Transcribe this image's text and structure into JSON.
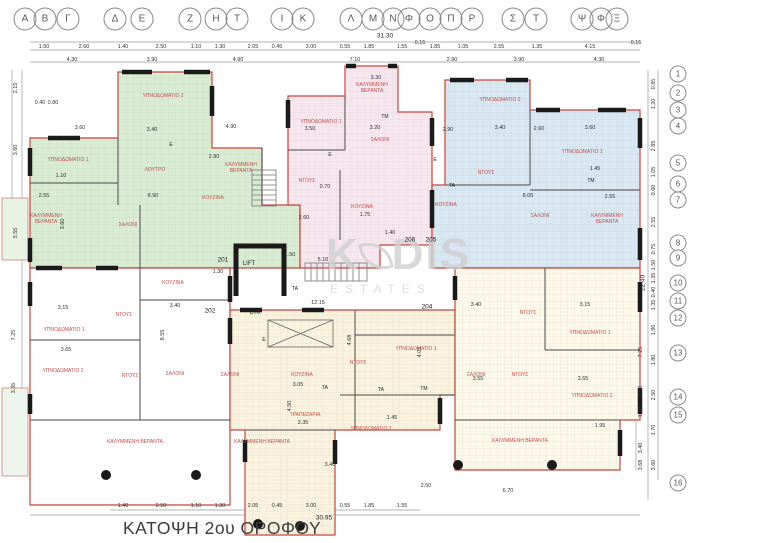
{
  "title": "ΚΑΤΟΨΗ 2ου ΟΡΟΦΟΥ",
  "lift_label": "LIFT",
  "watermark": {
    "part1": "K",
    "part2": "DIS",
    "sub": "ESTATES"
  },
  "colors": {
    "unit_green": "#d9ecd3",
    "unit_pink": "#f6e7ef",
    "unit_blue": "#d9e7f3",
    "unit_white": "#fefefe",
    "unit_cream": "#f9f2df",
    "unit_pale": "#fcf8ea",
    "outline_red": "#c5463d",
    "label_red": "#c0504d",
    "wall_black": "#1a1a1a"
  },
  "grid_letters": [
    {
      "ch": "Α",
      "x": 25
    },
    {
      "ch": "Β",
      "x": 45
    },
    {
      "ch": "Γ",
      "x": 68
    },
    {
      "ch": "Δ",
      "x": 115
    },
    {
      "ch": "Ε",
      "x": 142
    },
    {
      "ch": "Ζ",
      "x": 190
    },
    {
      "ch": "Η",
      "x": 216
    },
    {
      "ch": "Τ",
      "x": 237
    },
    {
      "ch": "Ι",
      "x": 282
    },
    {
      "ch": "Κ",
      "x": 303
    },
    {
      "ch": "Λ",
      "x": 351
    },
    {
      "ch": "Μ",
      "x": 373
    },
    {
      "ch": "Ν",
      "x": 393
    },
    {
      "ch": "Φ",
      "x": 409
    },
    {
      "ch": "Ο",
      "x": 430
    },
    {
      "ch": "Π",
      "x": 451
    },
    {
      "ch": "Ρ",
      "x": 472
    },
    {
      "ch": "Σ",
      "x": 513
    },
    {
      "ch": "Τ",
      "x": 536
    },
    {
      "ch": "Ψ",
      "x": 582
    },
    {
      "ch": "Φ",
      "x": 601
    },
    {
      "ch": "Ξ",
      "x": 617
    }
  ],
  "grid_numbers": [
    {
      "n": "1",
      "y": 74
    },
    {
      "n": "2",
      "y": 93
    },
    {
      "n": "3",
      "y": 110
    },
    {
      "n": "4",
      "y": 126
    },
    {
      "n": "5",
      "y": 163
    },
    {
      "n": "6",
      "y": 184
    },
    {
      "n": "7",
      "y": 200
    },
    {
      "n": "8",
      "y": 243
    },
    {
      "n": "9",
      "y": 258
    },
    {
      "n": "10",
      "y": 283
    },
    {
      "n": "11",
      "y": 301
    },
    {
      "n": "12",
      "y": 318
    },
    {
      "n": "13",
      "y": 353
    },
    {
      "n": "14",
      "y": 397
    },
    {
      "n": "15",
      "y": 415
    },
    {
      "n": "16",
      "y": 483
    }
  ],
  "units": [
    {
      "no": "201",
      "x": 223,
      "y": 260,
      "fill": "#d9ecd3"
    },
    {
      "no": "202",
      "x": 210,
      "y": 311,
      "fill": "#fefefe"
    },
    {
      "no": "203",
      "x": 255,
      "y": 312,
      "fill": "#f9f2df"
    },
    {
      "no": "204",
      "x": 427,
      "y": 307,
      "fill": "#fcf8ea"
    },
    {
      "no": "205",
      "x": 431,
      "y": 240,
      "fill": "#d9e7f3"
    },
    {
      "no": "206",
      "x": 410,
      "y": 240,
      "fill": "#f6e7ef"
    }
  ],
  "rooms": [
    {
      "t": "ΥΠΝΟΔΩΜΑΤΙΟ 2",
      "x": 163,
      "y": 96
    },
    {
      "t": "ΥΠΝΟΔΩΜΑΤΙΟ 1",
      "x": 68,
      "y": 160
    },
    {
      "t": "ΛΟΥΤΡΟ",
      "x": 155,
      "y": 170
    },
    {
      "t": "ΚΟΥΖΙΝΑ",
      "x": 213,
      "y": 198
    },
    {
      "t": "ΚΑΛΥΜΜΕΝΗ ΒΕΡΑΝΤΑ",
      "x": 46,
      "y": 219,
      "w": 40
    },
    {
      "t": "ΚΑΛΥΜΜΕΝΗ ΒΕΡΑΝΤΑ",
      "x": 241,
      "y": 168,
      "w": 40
    },
    {
      "t": "ΣΑΛΟΝΙ",
      "x": 128,
      "y": 225
    },
    {
      "t": "ΚΑΛΥΜΜΕΝΗ ΒΕΡΑΝΤΑ",
      "x": 372,
      "y": 88,
      "w": 44
    },
    {
      "t": "ΥΠΝΟΔΩΜΑΤΙΟ 1",
      "x": 321,
      "y": 122
    },
    {
      "t": "TM",
      "x": 385,
      "y": 117,
      "c": "#222"
    },
    {
      "t": "ΣΑΛΟΝΙ",
      "x": 380,
      "y": 140
    },
    {
      "t": "ΝΤΟΥΣ",
      "x": 307,
      "y": 181
    },
    {
      "t": "ΚΟΥΖΙΝΑ",
      "x": 362,
      "y": 207
    },
    {
      "t": "ΥΠΝΟΔΩΜΑΤΙΟ 2",
      "x": 500,
      "y": 100
    },
    {
      "t": "ΥΠΝΟΔΩΜΑΤΙΟ 1",
      "x": 582,
      "y": 152
    },
    {
      "t": "ΝΤΟΥΣ",
      "x": 486,
      "y": 173
    },
    {
      "t": "ΚΟΥΖΙΝΑ",
      "x": 446,
      "y": 205
    },
    {
      "t": "ΣΑΛΟΝΙ",
      "x": 540,
      "y": 216
    },
    {
      "t": "ΚΑΛΥΜΜΕΝΗ ΒΕΡΑΝΤΑ",
      "x": 607,
      "y": 219,
      "w": 44
    },
    {
      "t": "TM",
      "x": 591,
      "y": 181,
      "c": "#222"
    },
    {
      "t": "TA",
      "x": 452,
      "y": 186,
      "c": "#222"
    },
    {
      "t": "ΚΟΥΖΙΝΑ",
      "x": 173,
      "y": 283
    },
    {
      "t": "ΥΠΝΟΔΩΜΑΤΙΟ 1",
      "x": 64,
      "y": 330
    },
    {
      "t": "ΝΤΟΥΣ",
      "x": 124,
      "y": 315
    },
    {
      "t": "ΥΠΝΟΔΩΜΑΤΙΟ 2",
      "x": 63,
      "y": 371
    },
    {
      "t": "ΝΤΟΥΣ",
      "x": 130,
      "y": 376
    },
    {
      "t": "ΣΑΛΟΝΙ",
      "x": 175,
      "y": 374
    },
    {
      "t": "ΚΑΛΥΜΜΕΝΗ ΒΕΡΑΝΤΑ",
      "x": 135,
      "y": 442
    },
    {
      "t": "ΣΑΛΟΝΙ",
      "x": 230,
      "y": 375
    },
    {
      "t": "ΚΟΥΖΙΝΑ",
      "x": 302,
      "y": 375
    },
    {
      "t": "ΝΤΟΥΣ",
      "x": 358,
      "y": 363
    },
    {
      "t": "ΥΠΝΟΔΩΜΑΤΙΟ 1",
      "x": 416,
      "y": 349
    },
    {
      "t": "ΤΡΑΠΕΖΑΡΙΑ",
      "x": 305,
      "y": 415
    },
    {
      "t": "ΥΠΝΟΔΩΜΑΤΙΟ 2",
      "x": 371,
      "y": 429
    },
    {
      "t": "ΚΑΛΥΜΜΕΝΗ ΒΕΡΑΝΤΑ",
      "x": 262,
      "y": 442
    },
    {
      "t": "TA",
      "x": 325,
      "y": 388,
      "c": "#222"
    },
    {
      "t": "TA",
      "x": 381,
      "y": 390,
      "c": "#222"
    },
    {
      "t": "TM",
      "x": 424,
      "y": 389,
      "c": "#222"
    },
    {
      "t": "ΝΤΟΥΣ",
      "x": 528,
      "y": 313
    },
    {
      "t": "ΥΠΝΟΔΩΜΑΤΙΟ 1",
      "x": 590,
      "y": 333
    },
    {
      "t": "ΣΑΛΟΝΙ",
      "x": 476,
      "y": 375
    },
    {
      "t": "ΝΤΟΥΣ",
      "x": 520,
      "y": 375
    },
    {
      "t": "ΥΠΝΟΔΩΜΑΤΙΟ 2",
      "x": 592,
      "y": 396
    },
    {
      "t": "ΚΑΛΥΜΜΕΝΗ ΒΕΡΑΝΤΑ",
      "x": 520,
      "y": 441
    },
    {
      "t": "TA",
      "x": 295,
      "y": 289,
      "c": "#222"
    },
    {
      "t": "E",
      "x": 171,
      "y": 145,
      "c": "#222"
    },
    {
      "t": "E",
      "x": 330,
      "y": 155,
      "c": "#222"
    },
    {
      "t": "E",
      "x": 435,
      "y": 160,
      "c": "#222"
    },
    {
      "t": "E",
      "x": 264,
      "y": 340,
      "c": "#222"
    }
  ],
  "dims": {
    "top_total": "31.30",
    "bottom_total": "30.95",
    "right_total": "22.40",
    "top_row1": [
      {
        "v": "1.50",
        "x": 44,
        "y": 47
      },
      {
        "v": "2.60",
        "x": 84,
        "y": 47
      },
      {
        "v": "1.40",
        "x": 123,
        "y": 47
      },
      {
        "v": "2.50",
        "x": 161,
        "y": 47
      },
      {
        "v": "1.10",
        "x": 196,
        "y": 47
      },
      {
        "v": "1.30",
        "x": 220,
        "y": 47
      },
      {
        "v": "2.05",
        "x": 253,
        "y": 47
      },
      {
        "v": "0.45",
        "x": 277,
        "y": 47
      },
      {
        "v": "3.00",
        "x": 311,
        "y": 47
      },
      {
        "v": "0.55",
        "x": 345,
        "y": 47
      },
      {
        "v": "1.85",
        "x": 369,
        "y": 47
      },
      {
        "v": "1.55",
        "x": 402,
        "y": 47
      },
      {
        "v": "0.15",
        "x": 420,
        "y": 43
      },
      {
        "v": "1.85",
        "x": 435,
        "y": 47
      },
      {
        "v": "1.05",
        "x": 463,
        "y": 47
      },
      {
        "v": "2.55",
        "x": 499,
        "y": 47
      },
      {
        "v": "1.35",
        "x": 537,
        "y": 47
      },
      {
        "v": "4.15",
        "x": 590,
        "y": 47
      },
      {
        "v": "0.15",
        "x": 636,
        "y": 43
      }
    ],
    "top_row2": [
      {
        "v": "4.30",
        "x": 72,
        "y": 60
      },
      {
        "v": "3.90",
        "x": 152,
        "y": 60
      },
      {
        "v": "4.90",
        "x": 238,
        "y": 60
      },
      {
        "v": "7.10",
        "x": 355,
        "y": 60
      },
      {
        "v": "2.90",
        "x": 452,
        "y": 60
      },
      {
        "v": "3.90",
        "x": 519,
        "y": 60
      },
      {
        "v": "4.30",
        "x": 599,
        "y": 60
      }
    ],
    "bottom_row": [
      {
        "v": "1.40",
        "x": 123,
        "y": 506
      },
      {
        "v": "2.50",
        "x": 161,
        "y": 506
      },
      {
        "v": "1.10",
        "x": 196,
        "y": 506
      },
      {
        "v": "1.30",
        "x": 220,
        "y": 506
      },
      {
        "v": "2.05",
        "x": 253,
        "y": 506
      },
      {
        "v": "0.45",
        "x": 277,
        "y": 506
      },
      {
        "v": "3.00",
        "x": 311,
        "y": 506
      },
      {
        "v": "0.55",
        "x": 345,
        "y": 506
      },
      {
        "v": "1.85",
        "x": 369,
        "y": 506
      },
      {
        "v": "1.55",
        "x": 402,
        "y": 506
      }
    ],
    "right_chain": [
      {
        "v": "0.85",
        "x": 654,
        "y": 84,
        "rot": 1
      },
      {
        "v": "1.20",
        "x": 654,
        "y": 104,
        "rot": 1
      },
      {
        "v": "2.85",
        "x": 654,
        "y": 146,
        "rot": 1
      },
      {
        "v": "1.05",
        "x": 654,
        "y": 172,
        "rot": 1
      },
      {
        "v": "0.60",
        "x": 654,
        "y": 190,
        "rot": 1
      },
      {
        "v": "2.55",
        "x": 654,
        "y": 222,
        "rot": 1
      },
      {
        "v": "0.75",
        "x": 654,
        "y": 249,
        "rot": 1
      },
      {
        "v": "1.50",
        "x": 654,
        "y": 265,
        "rot": 1
      },
      {
        "v": "1.35",
        "x": 654,
        "y": 278,
        "rot": 1
      },
      {
        "v": "0.40",
        "x": 654,
        "y": 292,
        "rot": 1
      },
      {
        "v": "1.35",
        "x": 654,
        "y": 305,
        "rot": 1
      },
      {
        "v": "1.90",
        "x": 654,
        "y": 330,
        "rot": 1
      },
      {
        "v": "1.80",
        "x": 654,
        "y": 360,
        "rot": 1
      },
      {
        "v": "2.50",
        "x": 654,
        "y": 395,
        "rot": 1
      },
      {
        "v": "1.70",
        "x": 654,
        "y": 430,
        "rot": 1
      },
      {
        "v": "3.60",
        "x": 654,
        "y": 465,
        "rot": 1
      }
    ],
    "right_inner": [
      {
        "v": "7.25",
        "x": 641,
        "y": 352,
        "rot": 1
      },
      {
        "v": "2.50",
        "x": 641,
        "y": 391,
        "rot": 1
      },
      {
        "v": "1.10",
        "x": 641,
        "y": 412,
        "rot": 1
      },
      {
        "v": "3.40",
        "x": 641,
        "y": 448,
        "rot": 1
      },
      {
        "v": "3.68",
        "x": 641,
        "y": 465,
        "rot": 1
      }
    ],
    "left_chain": [
      {
        "v": "2.15",
        "x": 16,
        "y": 88,
        "rot": 1
      },
      {
        "v": "3.60",
        "x": 16,
        "y": 150,
        "rot": 1
      },
      {
        "v": "5.55",
        "x": 16,
        "y": 233,
        "rot": 1
      },
      {
        "v": "7.25",
        "x": 14,
        "y": 335,
        "rot": 1
      },
      {
        "v": "3.35",
        "x": 14,
        "y": 388,
        "rot": 1
      }
    ],
    "interior": [
      {
        "v": "0.40",
        "x": 40,
        "y": 103
      },
      {
        "v": "0.80",
        "x": 53,
        "y": 103
      },
      {
        "v": "3.60",
        "x": 80,
        "y": 128
      },
      {
        "v": "3.40",
        "x": 152,
        "y": 130
      },
      {
        "v": "4.90",
        "x": 231,
        "y": 127
      },
      {
        "v": "2.90",
        "x": 214,
        "y": 157
      },
      {
        "v": "1.10",
        "x": 61,
        "y": 176
      },
      {
        "v": "2.55",
        "x": 44,
        "y": 196
      },
      {
        "v": "8.90",
        "x": 153,
        "y": 196
      },
      {
        "v": "3.60",
        "x": 63,
        "y": 224,
        "rot": 1
      },
      {
        "v": "3.30",
        "x": 376,
        "y": 78
      },
      {
        "v": "3.50",
        "x": 310,
        "y": 129
      },
      {
        "v": "3.20",
        "x": 375,
        "y": 128
      },
      {
        "v": "0.70",
        "x": 325,
        "y": 187
      },
      {
        "v": "1.75",
        "x": 365,
        "y": 215
      },
      {
        "v": "1.40",
        "x": 390,
        "y": 233
      },
      {
        "v": "2.90",
        "x": 448,
        "y": 130
      },
      {
        "v": "3.40",
        "x": 500,
        "y": 128
      },
      {
        "v": "2.60",
        "x": 539,
        "y": 129
      },
      {
        "v": "3.60",
        "x": 590,
        "y": 128
      },
      {
        "v": "1.45",
        "x": 595,
        "y": 169
      },
      {
        "v": "8.05",
        "x": 528,
        "y": 196
      },
      {
        "v": "2.55",
        "x": 610,
        "y": 197
      },
      {
        "v": "2.60",
        "x": 304,
        "y": 218
      },
      {
        "v": "1.50",
        "x": 290,
        "y": 255
      },
      {
        "v": "5.10",
        "x": 323,
        "y": 260
      },
      {
        "v": "1.30",
        "x": 218,
        "y": 272
      },
      {
        "v": "12.15",
        "x": 318,
        "y": 303
      },
      {
        "v": "3.15",
        "x": 63,
        "y": 308
      },
      {
        "v": "3.40",
        "x": 175,
        "y": 306
      },
      {
        "v": "8.55",
        "x": 163,
        "y": 335,
        "rot": 1
      },
      {
        "v": "3.65",
        "x": 66,
        "y": 350
      },
      {
        "v": "3.05",
        "x": 298,
        "y": 385
      },
      {
        "v": "4.50",
        "x": 290,
        "y": 406,
        "rot": 1
      },
      {
        "v": "3.35",
        "x": 303,
        "y": 423
      },
      {
        "v": "1.45",
        "x": 392,
        "y": 418
      },
      {
        "v": "3.40",
        "x": 330,
        "y": 465
      },
      {
        "v": "3.55",
        "x": 478,
        "y": 379
      },
      {
        "v": "3.65",
        "x": 583,
        "y": 379
      },
      {
        "v": "3.15",
        "x": 585,
        "y": 305
      },
      {
        "v": "3.40",
        "x": 476,
        "y": 305
      },
      {
        "v": "1.95",
        "x": 600,
        "y": 426
      },
      {
        "v": "2.50",
        "x": 426,
        "y": 486
      },
      {
        "v": "6.70",
        "x": 508,
        "y": 491
      },
      {
        "v": "4.05",
        "x": 420,
        "y": 352,
        "rot": 1
      },
      {
        "v": "4.68",
        "x": 350,
        "y": 340,
        "rot": 1
      }
    ]
  }
}
